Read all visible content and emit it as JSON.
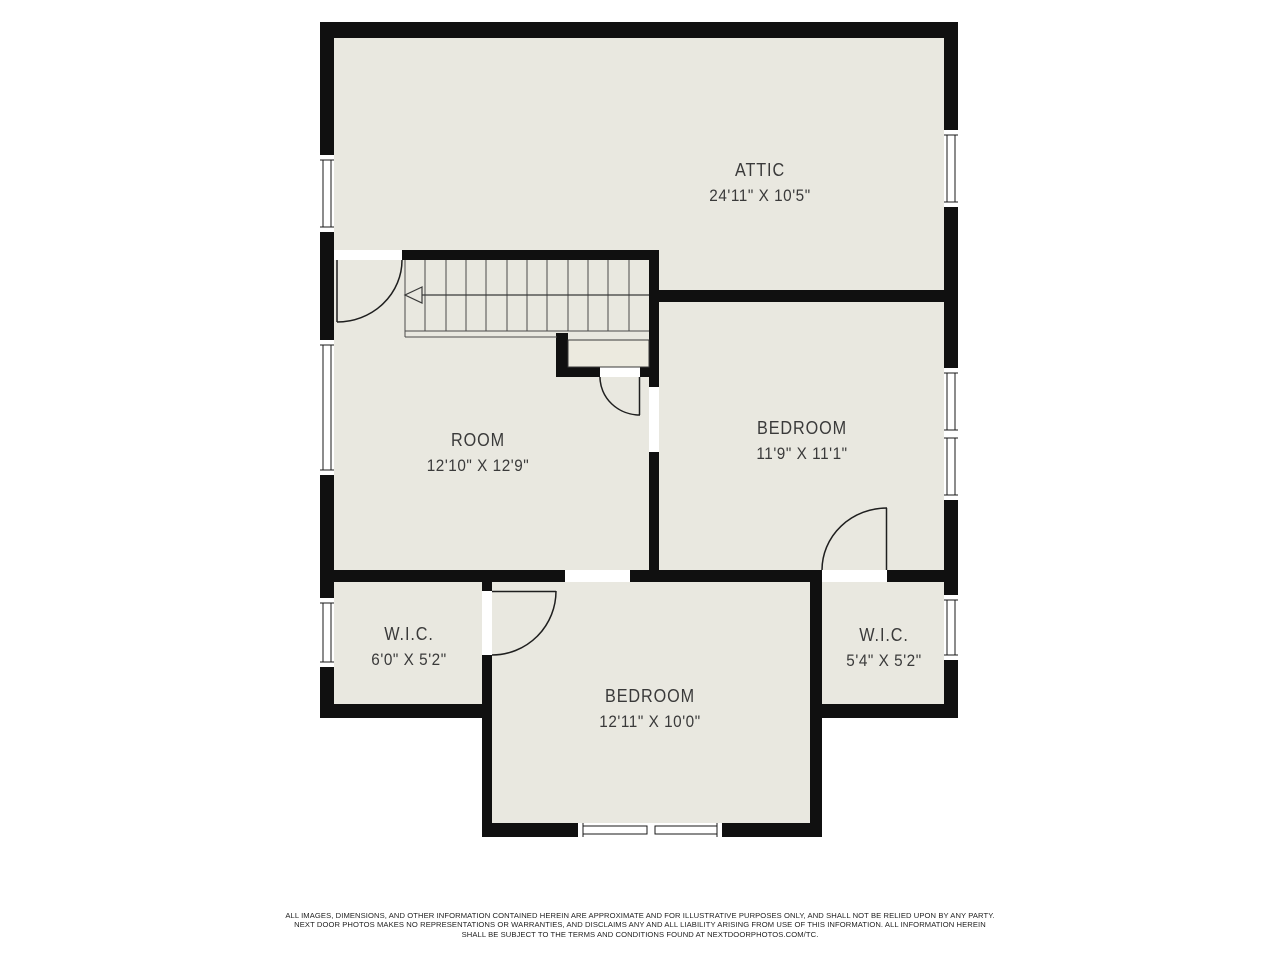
{
  "floor_plan": {
    "rooms": [
      {
        "id": "attic",
        "name": "ATTIC",
        "dimensions": "24'11\" X 10'5\""
      },
      {
        "id": "room",
        "name": "ROOM",
        "dimensions": "12'10\" X 12'9\""
      },
      {
        "id": "bedroom-upper",
        "name": "BEDROOM",
        "dimensions": "11'9\" X 11'1\""
      },
      {
        "id": "wic-left",
        "name": "W.I.C.",
        "dimensions": "6'0\" X 5'2\""
      },
      {
        "id": "bedroom-lower",
        "name": "BEDROOM",
        "dimensions": "12'11\" X 10'0\""
      },
      {
        "id": "wic-right",
        "name": "W.I.C.",
        "dimensions": "5'4\" X 5'2\""
      }
    ],
    "stairs": {
      "direction_arrow": "left"
    },
    "colors": {
      "wall": "#101010",
      "floor": "#e9e8e0",
      "background": "#ffffff",
      "label_text": "#3a3a3a"
    },
    "disclaimer_lines": [
      "ALL IMAGES, DIMENSIONS, AND OTHER INFORMATION CONTAINED HEREIN ARE APPROXIMATE AND FOR ILLUSTRATIVE PURPOSES ONLY, AND SHALL NOT BE RELIED UPON BY ANY PARTY.",
      "NEXT DOOR PHOTOS MAKES NO REPRESENTATIONS OR WARRANTIES, AND DISCLAIMS ANY AND ALL LIABILITY ARISING FROM USE OF THIS INFORMATION. ALL INFORMATION HEREIN",
      "SHALL BE SUBJECT TO THE TERMS AND CONDITIONS FOUND AT NEXTDOORPHOTOS.COM/TC."
    ]
  }
}
